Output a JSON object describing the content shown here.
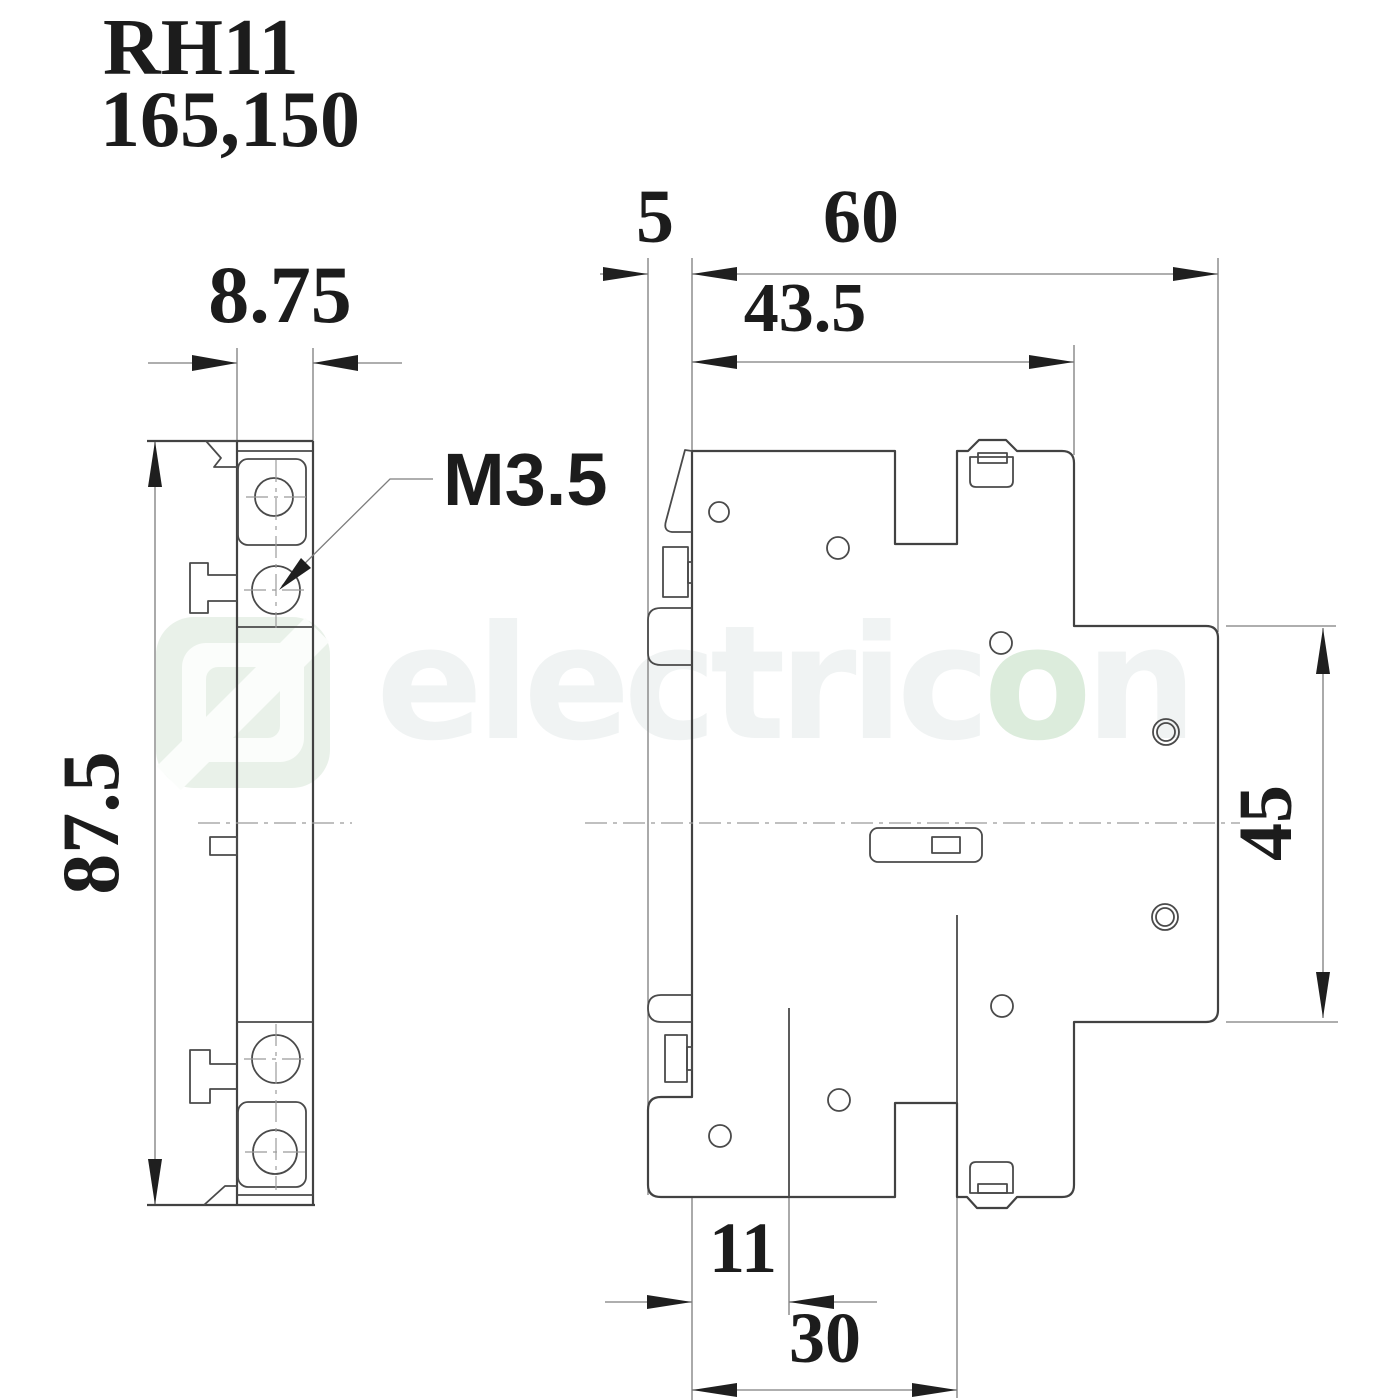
{
  "title": {
    "line1": "RH11",
    "line2": "165,150"
  },
  "watermark": {
    "part1": "electric",
    "part2": "o",
    "part3": "n"
  },
  "side_view": {
    "dim_width": "8.75",
    "dim_height": "87.5",
    "screw_callout": "M3.5"
  },
  "front_view": {
    "dim_rail_depth": "5",
    "dim_total_width": "60",
    "dim_body_width": "43.5",
    "dim_rail_height": "45",
    "dim_offset_bottom": "11",
    "dim_notch_width": "30"
  },
  "colors": {
    "background": "#ffffff",
    "outline": "#424242",
    "dimension_lines": "#7d7d7d",
    "centerline": "#9b9b9b",
    "text": "#1c1c1c",
    "watermark_green": "#e9f1e9",
    "watermark_text": "#f0f3f3"
  }
}
